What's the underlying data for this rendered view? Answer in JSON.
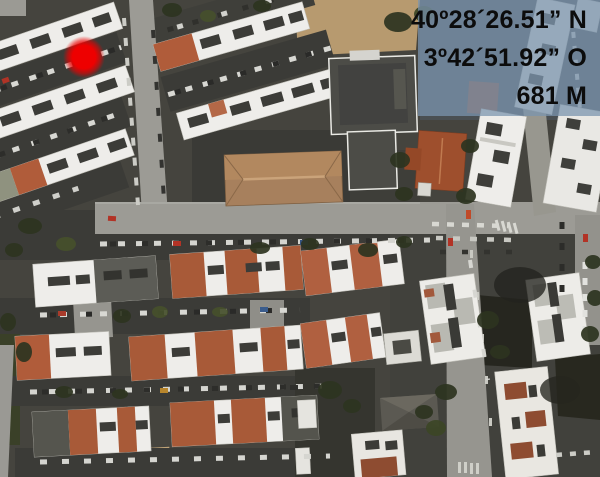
{
  "overlay": {
    "latitude": "40º28´26.51” N",
    "longitude": "3º42´51.92” O",
    "altitude": "681 M",
    "panel_color": "rgba(123,149,174,0.74)",
    "text_color": "#0c0c0c"
  },
  "marker": {
    "x": 84,
    "y": 57,
    "radius": 21,
    "color": "#ee0000"
  }
}
